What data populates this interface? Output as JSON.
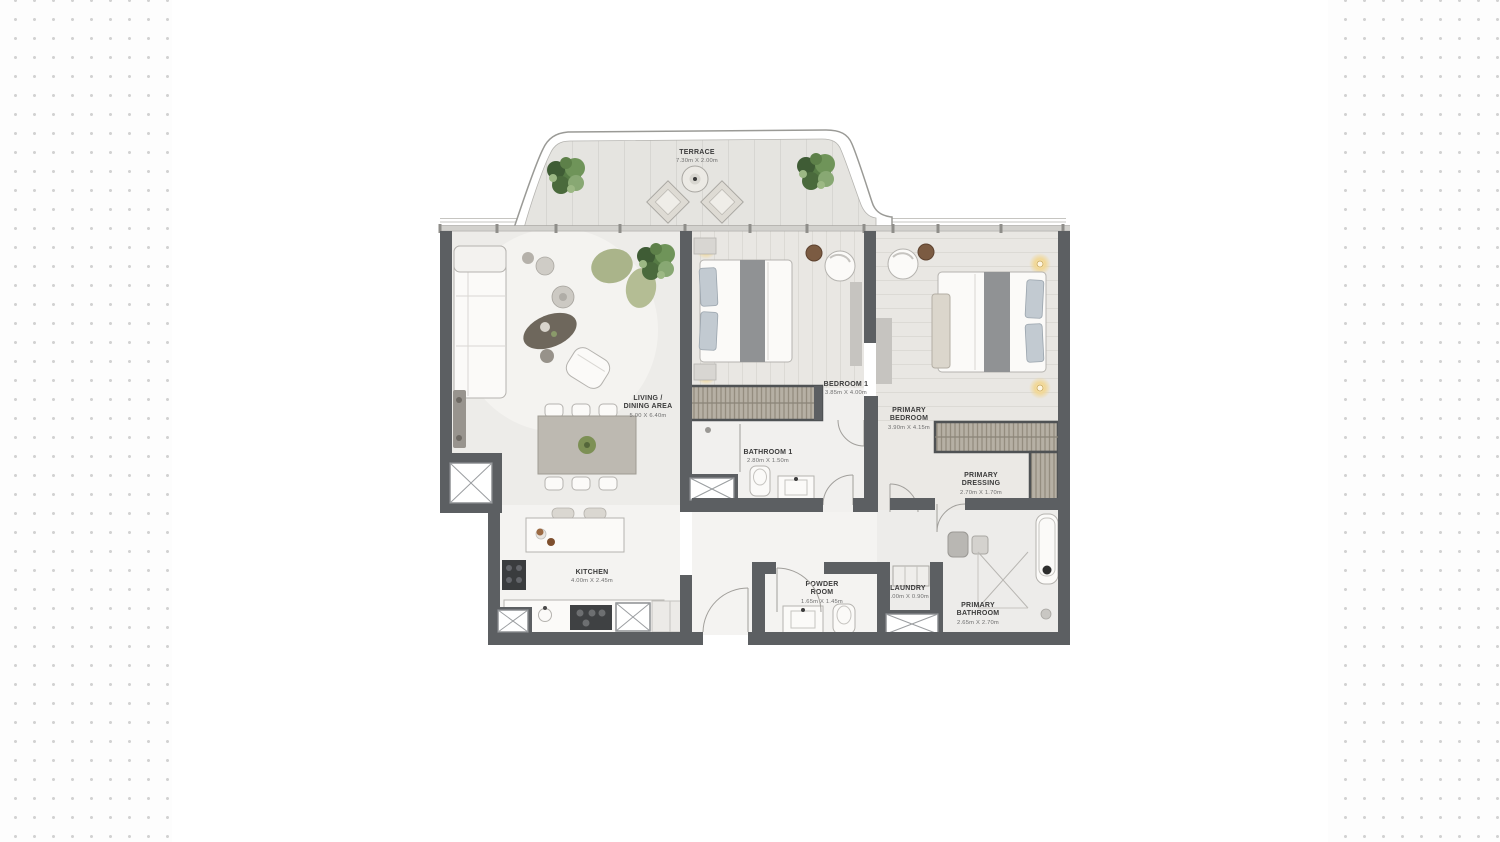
{
  "page": {
    "background_dot_color": "#d2d2d2",
    "panel_color": "#ffffff"
  },
  "floor_plan": {
    "type": "apartment-floor-plan",
    "rooms": [
      {
        "id": "terrace",
        "label_line1": "TERRACE",
        "label_line2": "",
        "dimensions": "7.30m X 2.00m"
      },
      {
        "id": "living_dining",
        "label_line1": "LIVING /",
        "label_line2": "DINING AREA",
        "dimensions": "5.00 X 6.40m"
      },
      {
        "id": "bedroom_1",
        "label_line1": "BEDROOM 1",
        "label_line2": "",
        "dimensions": "3.85m X 4.00m"
      },
      {
        "id": "primary_bedroom",
        "label_line1": "PRIMARY",
        "label_line2": "BEDROOM",
        "dimensions": "3.90m X 4.15m"
      },
      {
        "id": "bathroom_1",
        "label_line1": "BATHROOM 1",
        "label_line2": "",
        "dimensions": "2.80m X 1.50m"
      },
      {
        "id": "primary_dressing",
        "label_line1": "PRIMARY",
        "label_line2": "DRESSING",
        "dimensions": "2.70m X 1.70m"
      },
      {
        "id": "kitchen",
        "label_line1": "KITCHEN",
        "label_line2": "",
        "dimensions": "4.00m X 2.45m"
      },
      {
        "id": "powder_room",
        "label_line1": "POWDER",
        "label_line2": "ROOM",
        "dimensions": "1.65m X 1.45m"
      },
      {
        "id": "laundry",
        "label_line1": "LAUNDRY",
        "label_line2": "",
        "dimensions": "1.00m X 0.90m"
      },
      {
        "id": "primary_bathroom",
        "label_line1": "PRIMARY",
        "label_line2": "BATHROOM",
        "dimensions": "2.65m X 2.70m"
      }
    ],
    "colors": {
      "wall": "#5c5f62",
      "floor_light": "#edece9",
      "marble_floor": "#f4f3f1",
      "closet_hatch": "#b6b0a4",
      "plant_green": "#567b45",
      "rug_green": "#aab48a",
      "lamp_glow": "#f1d795",
      "bed_runner": "#909294",
      "pillow": "#c2cad1"
    }
  }
}
